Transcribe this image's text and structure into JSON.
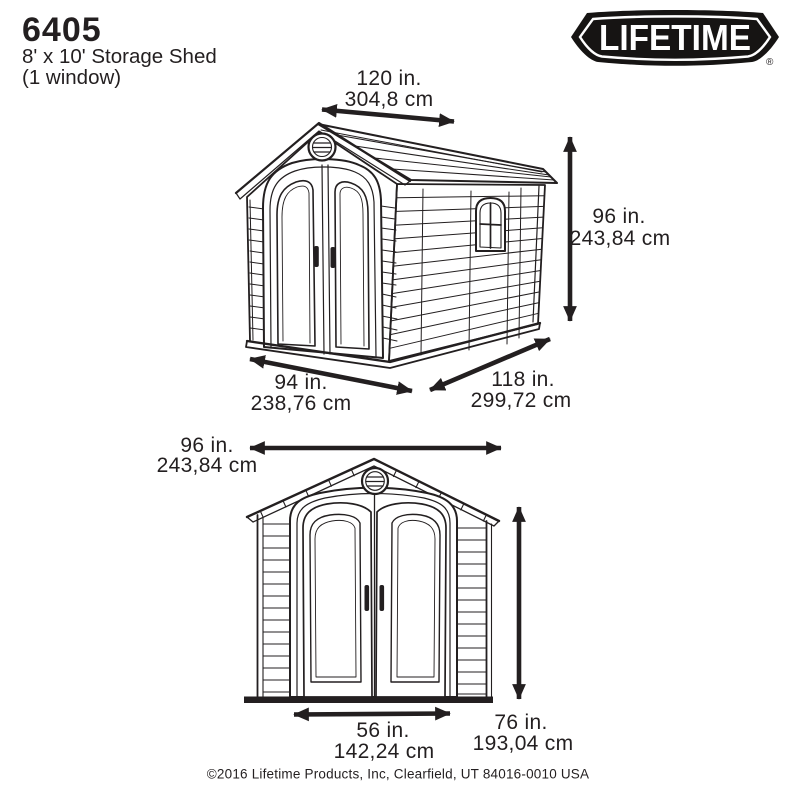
{
  "header": {
    "model": "6405",
    "product_name": "8' x 10' Storage Shed",
    "variant": "(1 window)"
  },
  "logo": {
    "text": "LIFETIME",
    "registered": "®"
  },
  "colors": {
    "ink": "#231f20",
    "background": "#ffffff",
    "logo_bg": "#161413",
    "logo_text": "#ffffff"
  },
  "perspective_view": {
    "roof_width": {
      "in": "120 in.",
      "cm": "304,8 cm"
    },
    "height": {
      "in": "96 in.",
      "cm": "243,84 cm"
    },
    "front_width": {
      "in": "94 in.",
      "cm": "238,76 cm"
    },
    "depth": {
      "in": "118 in.",
      "cm": "299,72 cm"
    }
  },
  "front_view": {
    "overall_width": {
      "in": "96 in.",
      "cm": "243,84 cm"
    },
    "door_width": {
      "in": "56 in.",
      "cm": "142,24 cm"
    },
    "wall_height": {
      "in": "76 in.",
      "cm": "193,04 cm"
    }
  },
  "footer": {
    "copyright": "©2016 Lifetime Products, Inc, Clearfield, UT 84016-0010 USA"
  }
}
